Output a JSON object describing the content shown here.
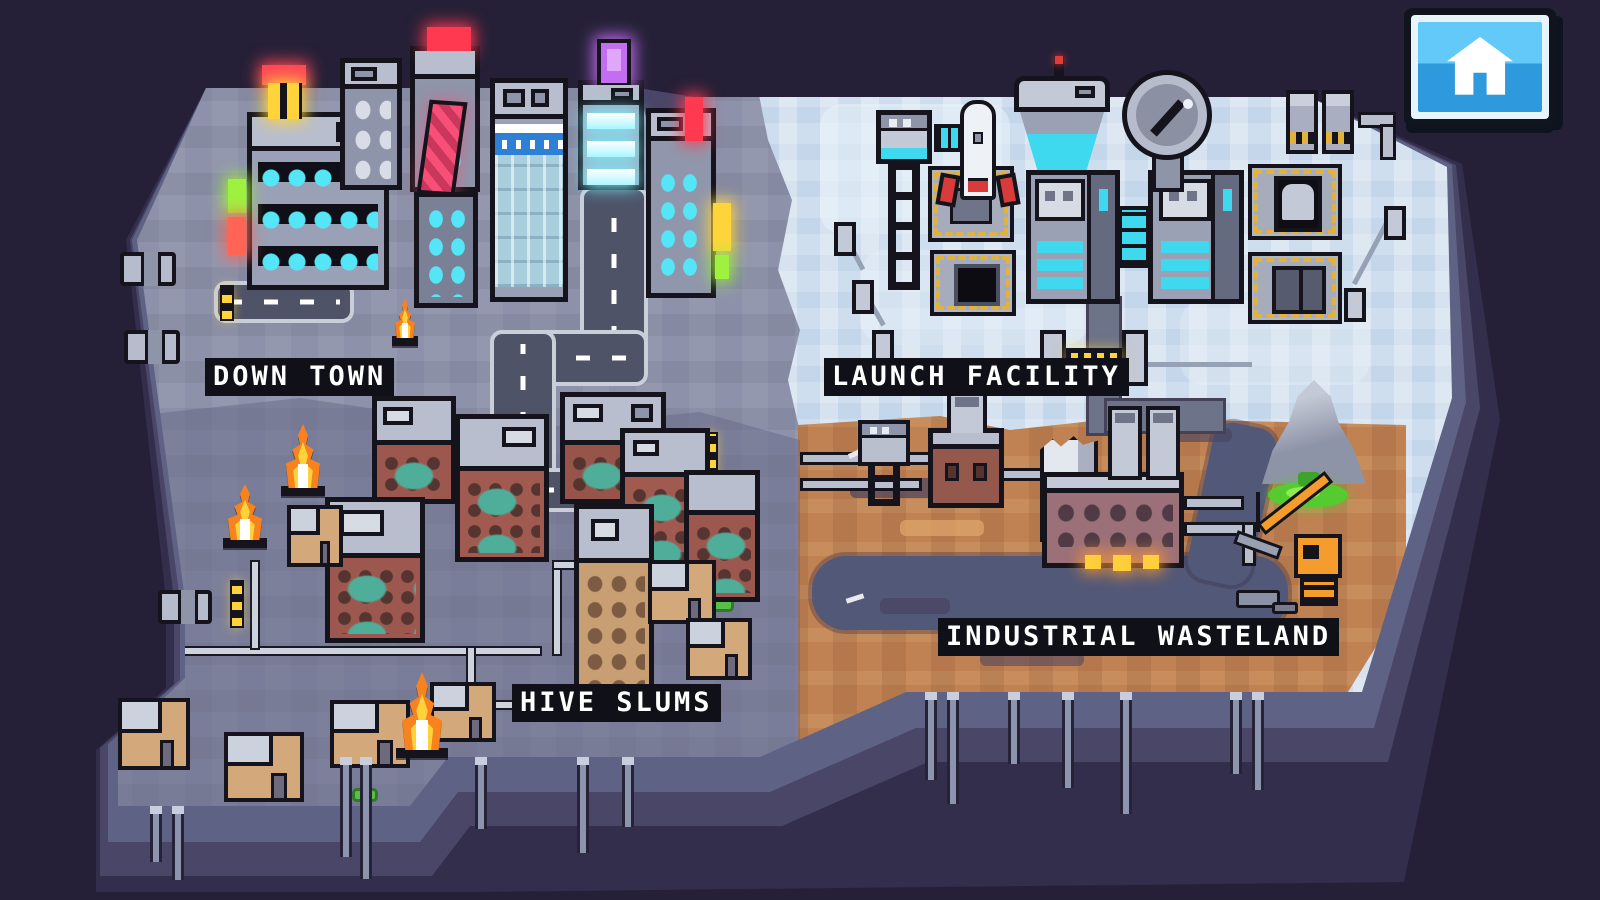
{
  "hud": {
    "home_button": {
      "icon": "home-icon"
    }
  },
  "regions": [
    {
      "id": "down-town",
      "label": "DOWN TOWN",
      "ground_color": "#8d92aa",
      "landmarks": [
        "neon-skyscrapers",
        "billboards",
        "city-roads",
        "street-fire"
      ]
    },
    {
      "id": "launch-facility",
      "label": "LAUNCH FACILITY",
      "ground_color": "#cfdeee",
      "landmarks": [
        "rocket-launch-pad",
        "open-missile-silo",
        "control-tower",
        "radar-dish",
        "water-tower",
        "research-labs",
        "machinery-pads",
        "security-gate",
        "vents"
      ]
    },
    {
      "id": "hive-slums",
      "label": "HIVE SLUMS",
      "ground_color": "#7e829e",
      "landmarks": [
        "brick-tenements",
        "shanty-huts",
        "burning-fires",
        "surface-pipes"
      ]
    },
    {
      "id": "industrial-wasteland",
      "label": "INDUSTRIAL WASTELAND",
      "ground_color": "#c08252",
      "landmarks": [
        "smelting-factory",
        "smokestacks",
        "boiler-house",
        "sludge-river",
        "slag-mountain",
        "toxic-pool",
        "crane",
        "rubble",
        "water-tower"
      ]
    }
  ],
  "palette": {
    "background": "#252037",
    "cliff_light": "#5e6284",
    "cliff_mid": "#4a4668",
    "cliff_dark": "#322e4b",
    "rim": "#ccd1df",
    "road": "#4e5368",
    "sidewalk": "#c9ced9",
    "window_cyan": "#54e6f6",
    "neon_red": "#ff4656",
    "neon_yellow": "#ffd43a",
    "neon_green": "#9ff13f",
    "neon_purple": "#c36df2",
    "brick": "#9c574e",
    "dirt": "#c08252",
    "ice": "#cfdeee",
    "fire_orange": "#f7821e",
    "toxic_green": "#55cb2f",
    "crane_orange": "#f59d2c",
    "button_blue": "#45b1ee"
  }
}
